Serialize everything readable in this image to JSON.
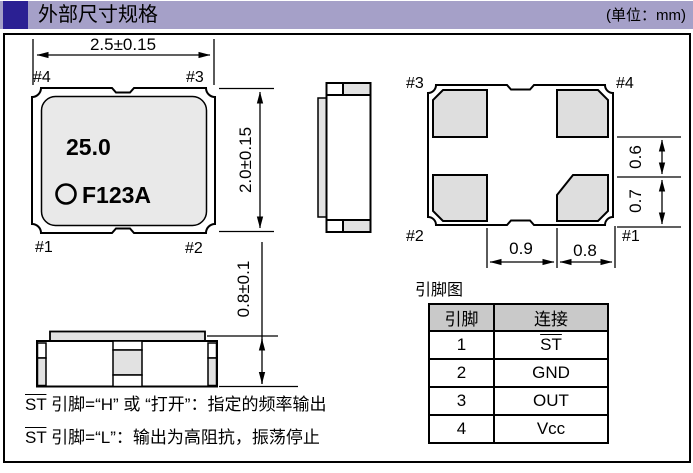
{
  "header": {
    "title": "外部尺寸规格",
    "unit": "(单位：mm)"
  },
  "colors": {
    "header_bar": "#a5a0c8",
    "header_block": "#2b2093",
    "package_body_fill": "#e9e9e9",
    "pad_fill": "#dedede",
    "table_header_bg": "#c9c9c9",
    "line_color": "#000000"
  },
  "top_view": {
    "marking_freq": "25.0",
    "marking_code": "F123A",
    "dim_width": "2.5±0.15",
    "dim_height": "2.0±0.15",
    "pin_top_left": "#4",
    "pin_top_right": "#3",
    "pin_bottom_left": "#1",
    "pin_bottom_right": "#2"
  },
  "bottom_view": {
    "pin_top_left": "#3",
    "pin_top_right": "#4",
    "pin_bottom_left": "#2",
    "pin_bottom_right": "#1",
    "dim_pad_gap": "0.9",
    "dim_pad_width": "0.8",
    "dim_gap_vertical": "0.6",
    "dim_pad_height": "0.7"
  },
  "front_view": {
    "dim_height": "0.8±0.1"
  },
  "notes": [
    {
      "signal": "ST",
      "text": " 引脚=“H” 或 “打开”：指定的频率输出",
      "overline": true
    },
    {
      "signal": "ST",
      "text": " 引脚=“L”：输出为高阻抗，振荡停止",
      "overline": true
    }
  ],
  "pin_table": {
    "title": "引脚图",
    "headers": [
      "引脚",
      "连接"
    ],
    "rows": [
      {
        "pin": "1",
        "connection": "ST",
        "overline": true
      },
      {
        "pin": "2",
        "connection": "GND",
        "overline": false
      },
      {
        "pin": "3",
        "connection": "OUT",
        "overline": false
      },
      {
        "pin": "4",
        "connection": "Vcc",
        "overline": false
      }
    ]
  }
}
